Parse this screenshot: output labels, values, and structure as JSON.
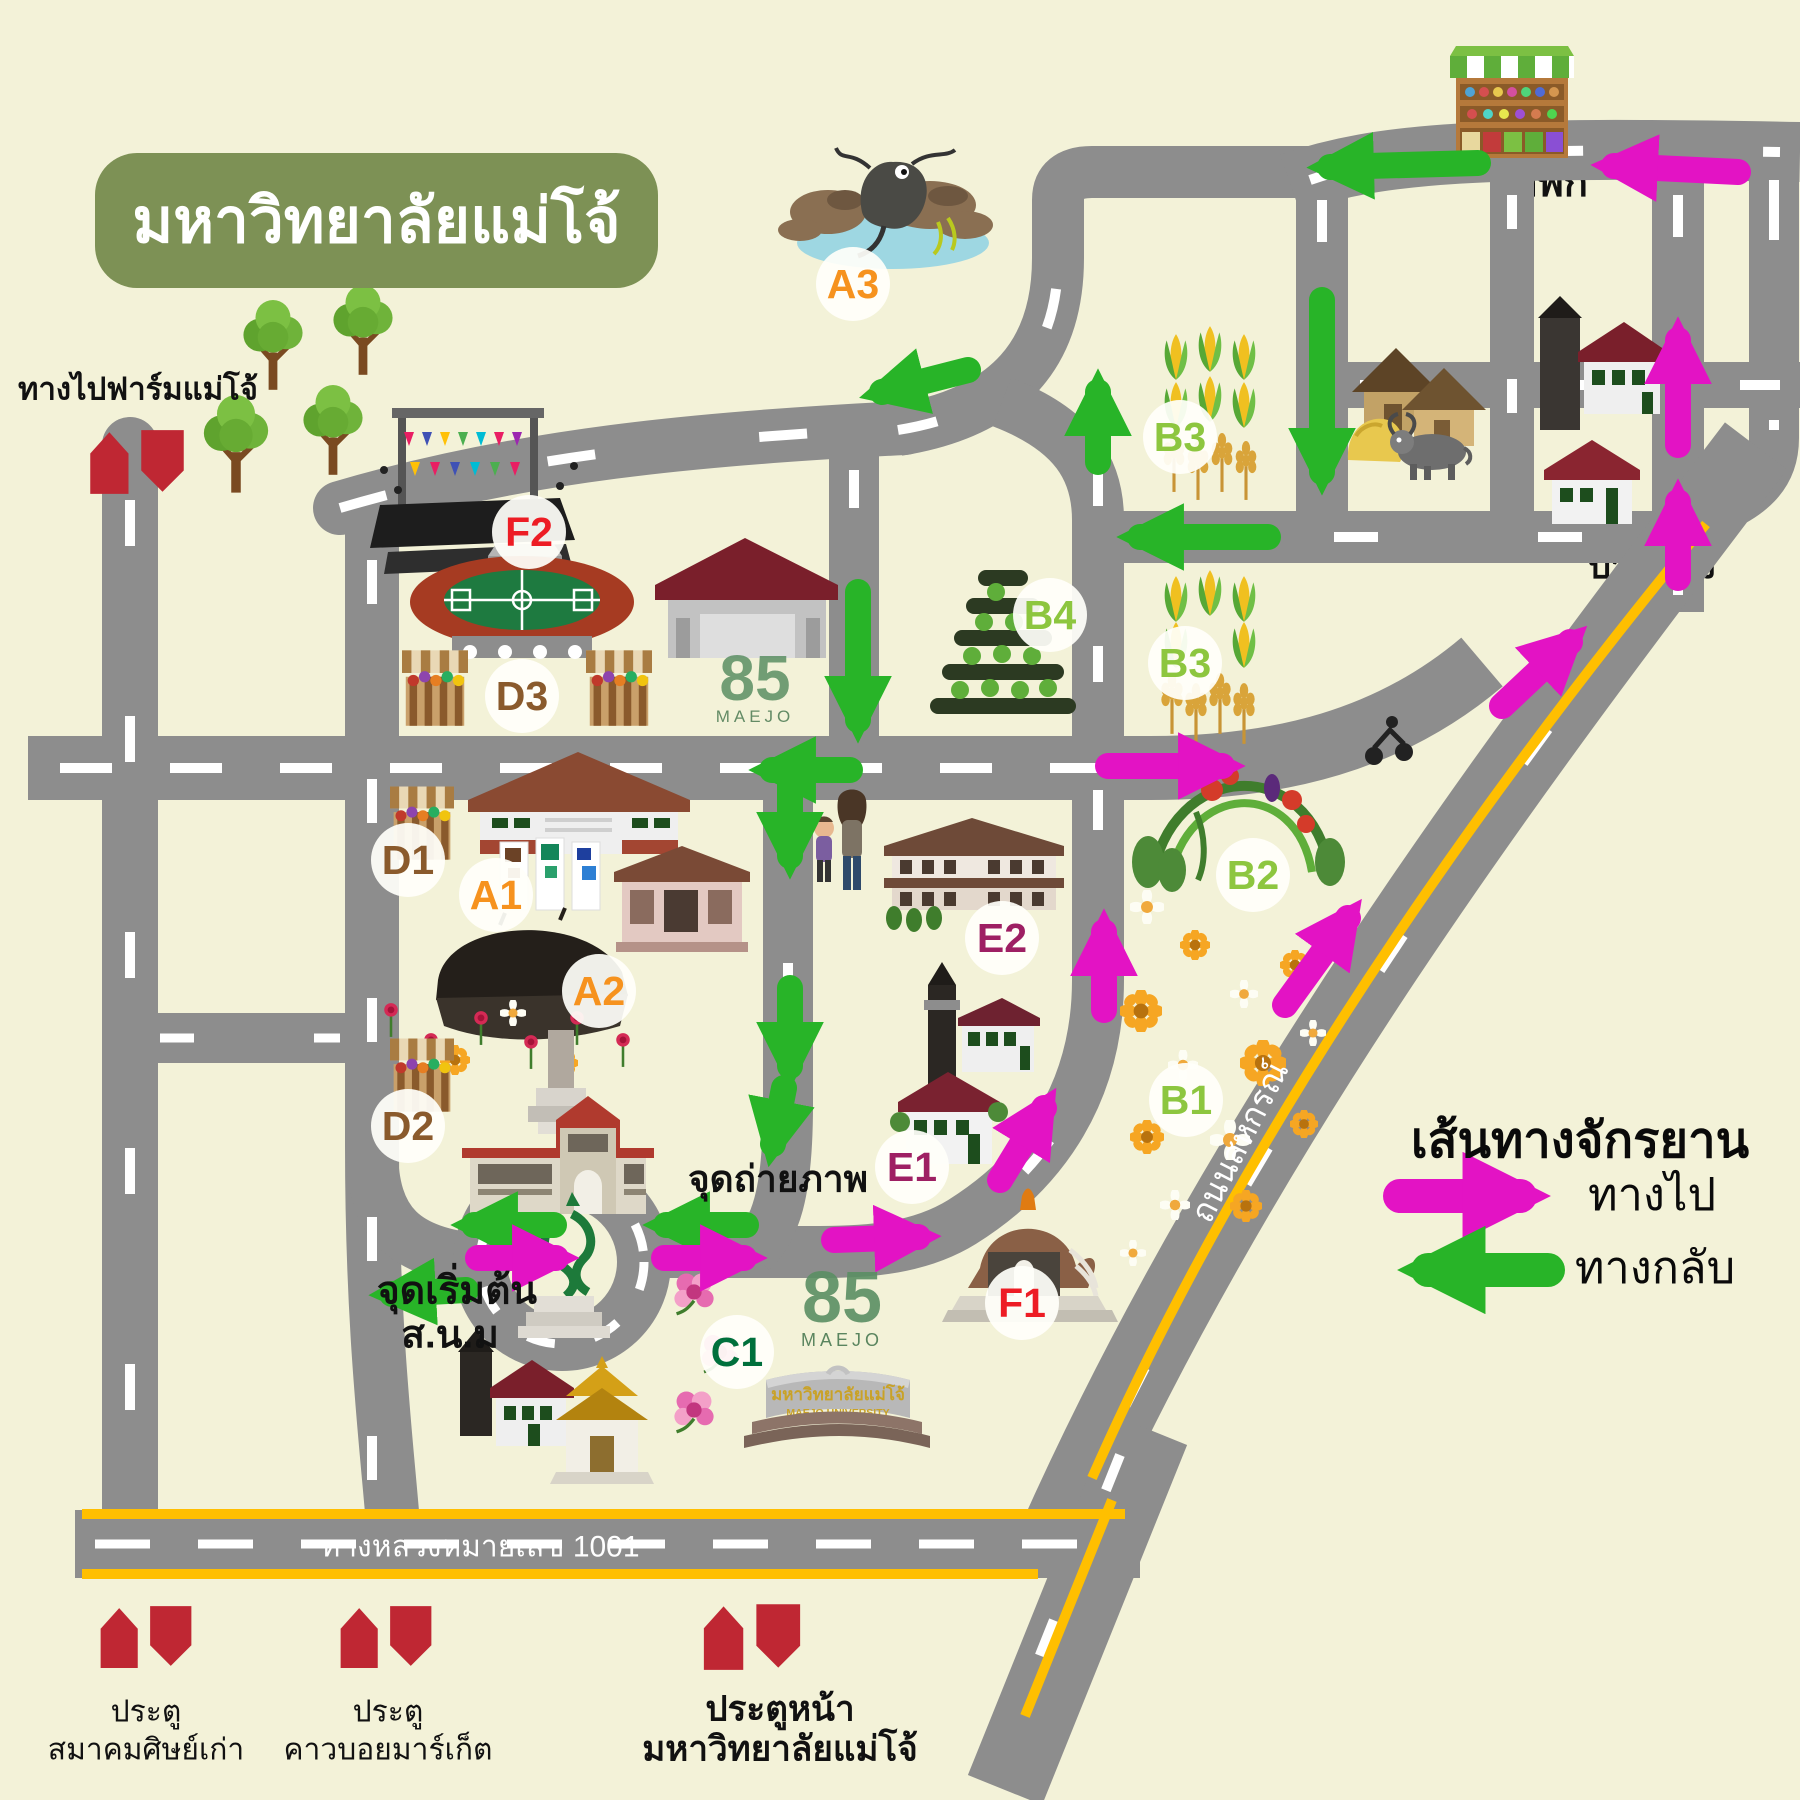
{
  "title": "มหาวิทยาลัยแม่โจ้",
  "legend": {
    "title": "เส้นทางจักรยาน",
    "outbound_label": "ทางไป",
    "return_label": "ทางกลับ",
    "outbound_color": "#e313c4",
    "return_color": "#28b428"
  },
  "university_sign": {
    "thai": "มหาวิทยาลัยแม่โจ้",
    "eng": "MAEJO  UNIVERSITY"
  },
  "logo85": {
    "number": "85",
    "sup": "th",
    "name": "MAEJO",
    "tagline": "The Wisdom of Agriculture"
  },
  "colors": {
    "background": "#f3f2d8",
    "road": "#8d8d8d",
    "road_marking": "#ffffff",
    "highway_line": "#ffbf00",
    "outbound_arrow": "#e313c4",
    "return_arrow": "#28b428",
    "gate_icon": "#bf2733",
    "title_badge": "#7d9155"
  },
  "map_labels": [
    {
      "id": "farm-direction",
      "text": "ทางไปฟาร์มแม่โจ้",
      "x": 138,
      "y": 390,
      "size": 31,
      "color": "#111111",
      "weight": 700
    },
    {
      "id": "rest-point",
      "text": "จุดพัก",
      "x": 1538,
      "y": 183,
      "size": 40,
      "color": "#111111",
      "weight": 700,
      "under": true
    },
    {
      "id": "village-pong",
      "text": "บ้านโปง",
      "x": 1652,
      "y": 566,
      "size": 36,
      "color": "#111111",
      "weight": 700,
      "under": true
    },
    {
      "id": "photo-point",
      "text": "จุดถ่ายภาพ",
      "x": 778,
      "y": 1180,
      "size": 37,
      "color": "#111111",
      "weight": 700
    },
    {
      "id": "start-point-line1",
      "text": "จุดเริ่มต้น",
      "x": 457,
      "y": 1292,
      "size": 39,
      "color": "#111111",
      "weight": 700
    },
    {
      "id": "start-point-line2",
      "text": "ส.น.ม",
      "x": 450,
      "y": 1336,
      "size": 39,
      "color": "#111111",
      "weight": 700
    },
    {
      "id": "highway-1001",
      "text": "ทางหลวงหมายเลข 1001",
      "x": 480,
      "y": 1547,
      "size": 30,
      "color": "#ffffff",
      "weight": 500
    },
    {
      "id": "sahakorn-road",
      "text": "ถนนสหกรณ์",
      "x": 1240,
      "y": 1142,
      "size": 33,
      "color": "#ffffff",
      "weight": 500,
      "rotate": -63
    },
    {
      "id": "gate1-line1",
      "text": "ประตู",
      "x": 146,
      "y": 1712,
      "size": 30,
      "color": "#111111",
      "weight": 500
    },
    {
      "id": "gate1-line2",
      "text": "สมาคมศิษย์เก่า",
      "x": 146,
      "y": 1750,
      "size": 30,
      "color": "#111111",
      "weight": 500
    },
    {
      "id": "gate2-line1",
      "text": "ประตู",
      "x": 388,
      "y": 1712,
      "size": 30,
      "color": "#111111",
      "weight": 500
    },
    {
      "id": "gate2-line2",
      "text": "คาวบอยมาร์เก็ต",
      "x": 388,
      "y": 1750,
      "size": 30,
      "color": "#111111",
      "weight": 500
    },
    {
      "id": "gate3-line1",
      "text": "ประตูหน้า",
      "x": 780,
      "y": 1710,
      "size": 35,
      "color": "#111111",
      "weight": 700
    },
    {
      "id": "gate3-line2",
      "text": "มหาวิทยาลัยแม่โจ้",
      "x": 780,
      "y": 1750,
      "size": 35,
      "color": "#111111",
      "weight": 700
    }
  ],
  "poi_markers": [
    {
      "code": "A1",
      "color": "#f6921e",
      "x": 496,
      "y": 895
    },
    {
      "code": "A2",
      "color": "#f6921e",
      "x": 599,
      "y": 991
    },
    {
      "code": "A3",
      "color": "#f6921e",
      "x": 853,
      "y": 284
    },
    {
      "code": "B1",
      "color": "#8dc63f",
      "x": 1186,
      "y": 1100
    },
    {
      "code": "B2",
      "color": "#8dc63f",
      "x": 1253,
      "y": 875
    },
    {
      "code": "B3",
      "color": "#8dc63f",
      "x": 1180,
      "y": 437
    },
    {
      "code": "B3",
      "color": "#8dc63f",
      "x": 1185,
      "y": 663
    },
    {
      "code": "B4",
      "color": "#8dc63f",
      "x": 1050,
      "y": 615
    },
    {
      "code": "C1",
      "color": "#00703c",
      "x": 737,
      "y": 1352
    },
    {
      "code": "D1",
      "color": "#8a5a2c",
      "x": 408,
      "y": 860
    },
    {
      "code": "D2",
      "color": "#8a5a2c",
      "x": 408,
      "y": 1126
    },
    {
      "code": "D3",
      "color": "#8a5a2c",
      "x": 522,
      "y": 696
    },
    {
      "code": "E1",
      "color": "#9e1f63",
      "x": 912,
      "y": 1167
    },
    {
      "code": "E2",
      "color": "#9e1f63",
      "x": 1002,
      "y": 938
    },
    {
      "code": "F1",
      "color": "#ed1c24",
      "x": 1022,
      "y": 1303
    },
    {
      "code": "F2",
      "color": "#ed1c24",
      "x": 529,
      "y": 532
    }
  ]
}
